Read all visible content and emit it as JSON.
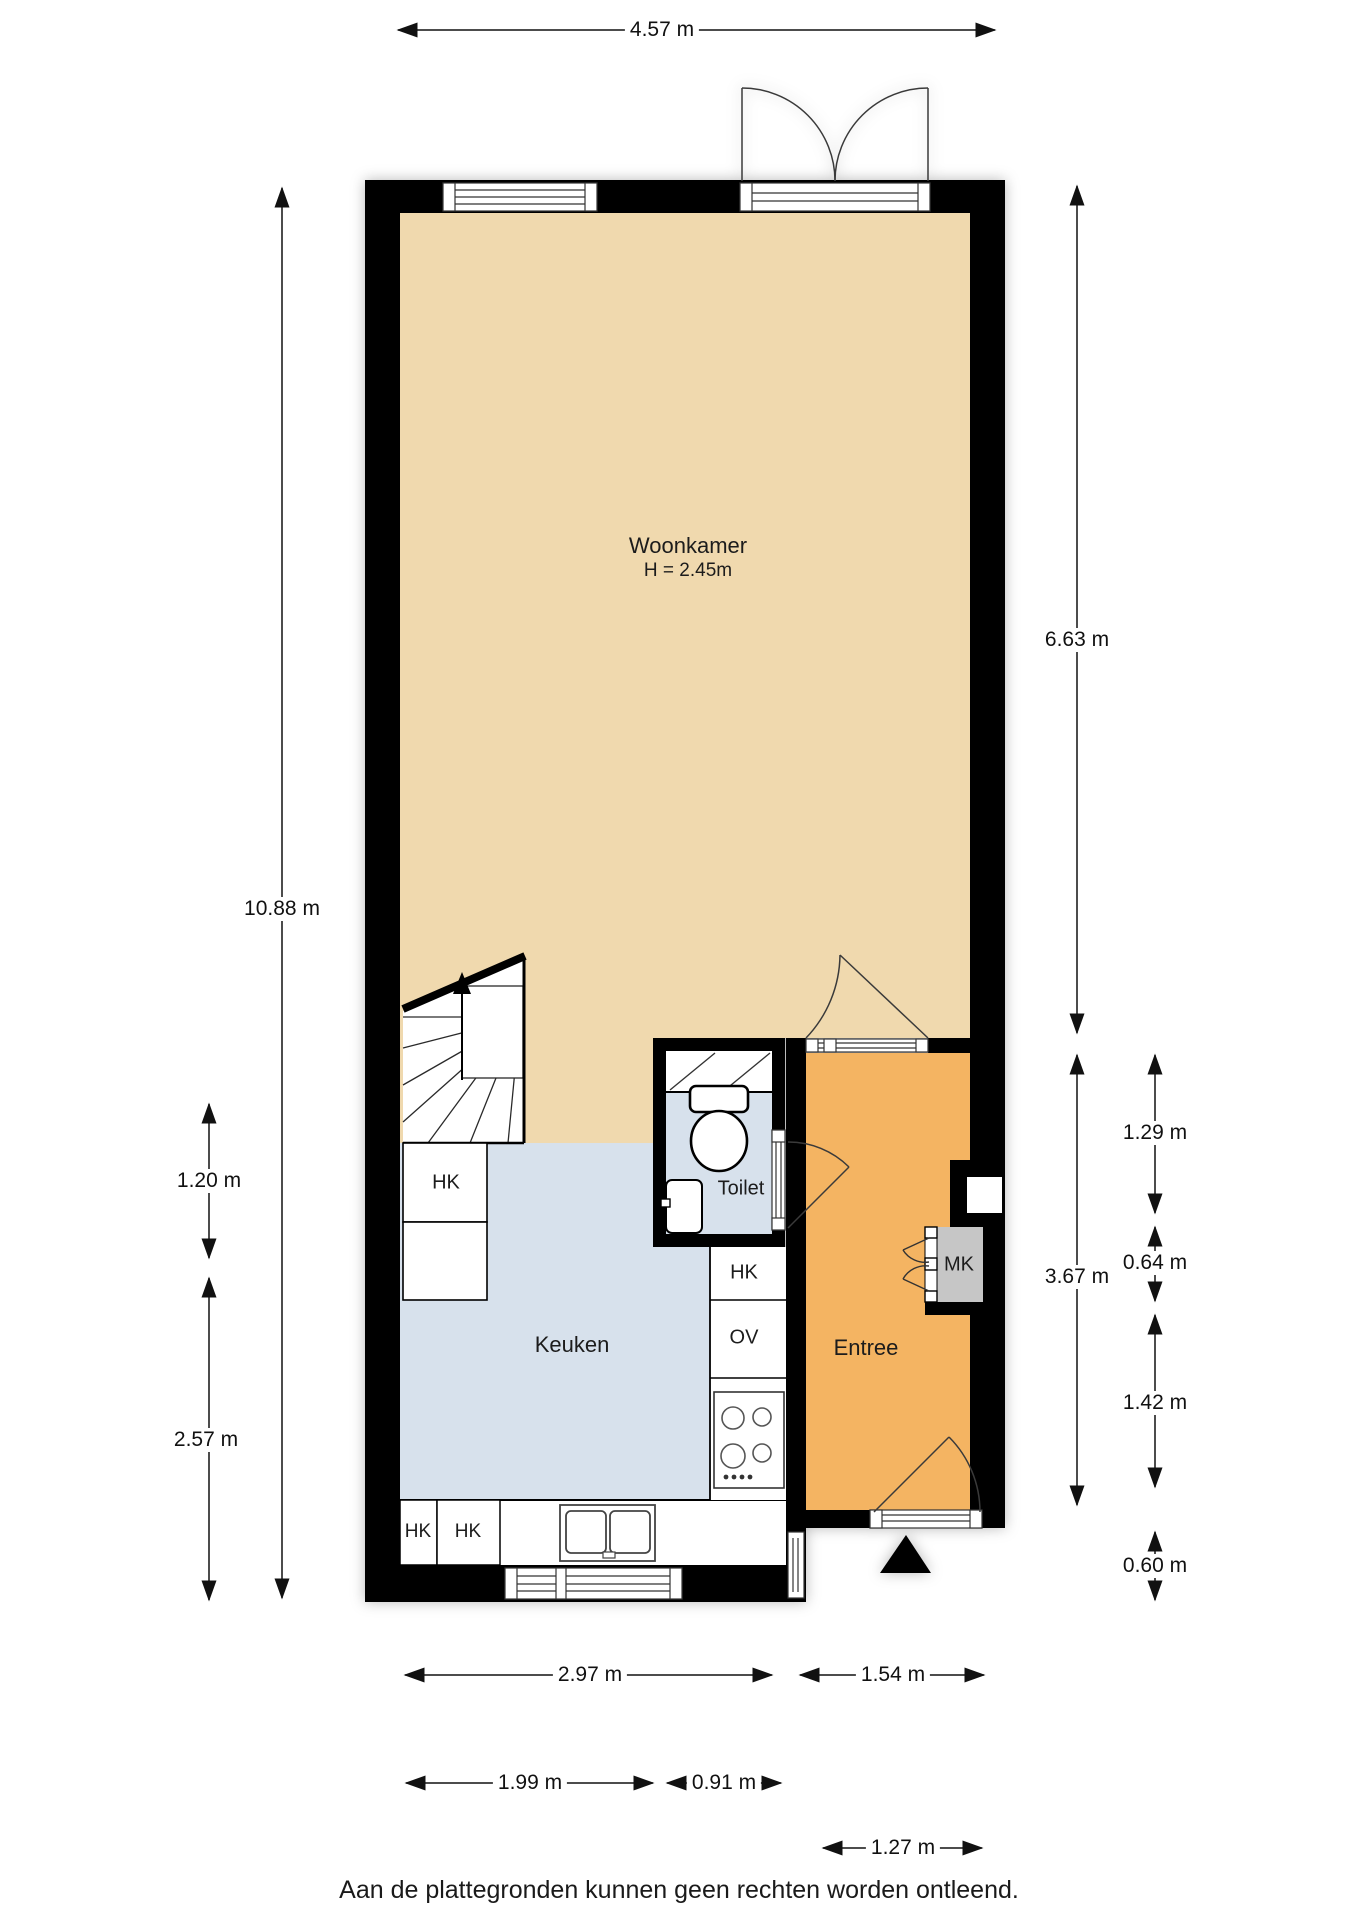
{
  "plan": {
    "rooms": {
      "woonkamer": {
        "label": "Woonkamer",
        "height": "H = 2.45m"
      },
      "keuken": {
        "label": "Keuken"
      },
      "toilet": {
        "label": "Toilet"
      },
      "entree": {
        "label": "Entree"
      }
    },
    "closets": {
      "hk_stairs": "HK",
      "hk_column": "HK",
      "ov": "OV",
      "hk_base_1": "HK",
      "hk_base_2": "HK",
      "mk": "MK"
    },
    "dimensions": {
      "top_width": "4.57 m",
      "left_total": "10.88 m",
      "left_upper": "1.20 m",
      "left_lower": "2.57 m",
      "right_living": "6.63 m",
      "right_hall": "3.67 m",
      "right_seg_1": "1.29 m",
      "right_seg_2": "0.64 m",
      "right_seg_3": "1.42 m",
      "right_seg_4": "0.60 m",
      "bottom_kitchen": "2.97 m",
      "bottom_entree": "1.54 m",
      "bottom_left": "1.99 m",
      "bottom_toilet": "0.91 m",
      "bottom_door": "1.27 m"
    },
    "colors": {
      "floor_living": "#F0D9AE",
      "floor_kitchen": "#D7E1EC",
      "floor_hall": "#F4B462",
      "floor_mk": "#C6C6C6",
      "wall": "#000000"
    }
  },
  "footer": {
    "disclaimer": "Aan de plattegronden kunnen geen rechten worden ontleend."
  }
}
